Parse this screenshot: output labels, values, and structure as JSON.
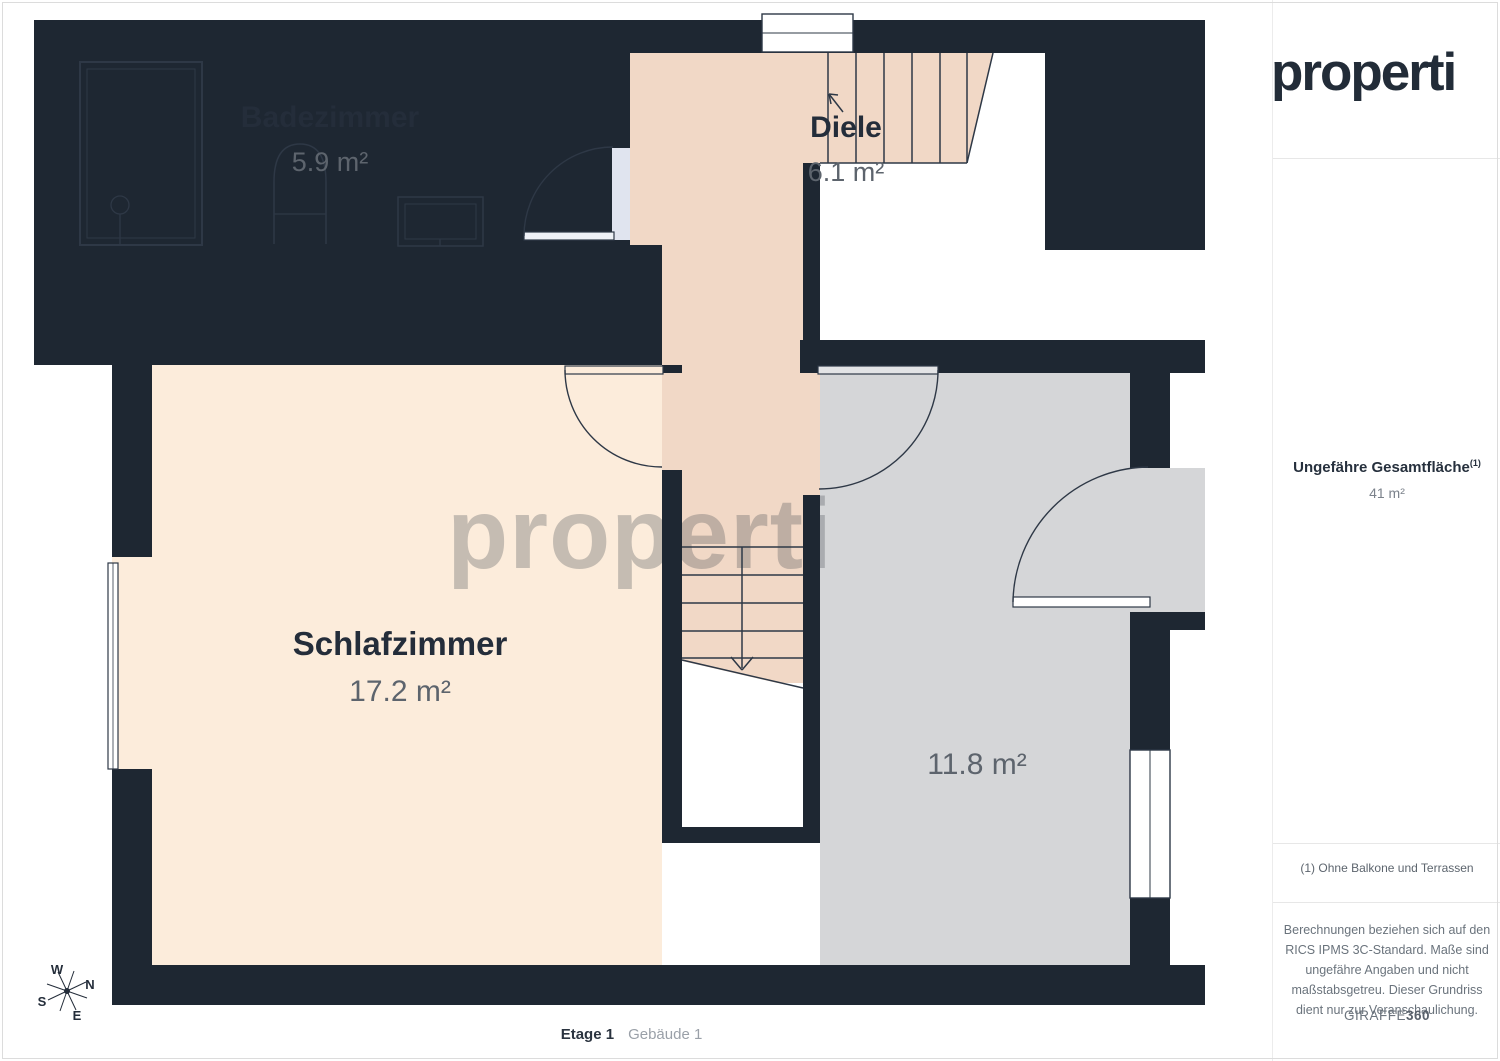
{
  "brand": {
    "logo": "properti",
    "watermark": "properti"
  },
  "floorplan": {
    "rooms": {
      "badezimmer": {
        "name": "Badezimmer",
        "area": "5.9 m²"
      },
      "diele": {
        "name": "Diele",
        "area": "6.1 m²"
      },
      "schlafzimmer": {
        "name": "Schlafzimmer",
        "area": "17.2 m²"
      },
      "room4": {
        "area": "11.8 m²"
      }
    },
    "compass": {
      "n": "N",
      "e": "E",
      "s": "S",
      "w": "W"
    }
  },
  "sidebar": {
    "total_area_label": "Ungefähre Gesamtfläche",
    "total_area_footnote_marker": "(1)",
    "total_area_value": "41 m²",
    "footnote": "(1) Ohne Balkone und Terrassen",
    "disclaimer": "Berechnungen beziehen sich auf den RICS IPMS 3C-Standard. Maße sind ungefähre Angaben und nicht maßstabsgetreu. Dieser Grundriss dient nur zur Veranschaulichung.",
    "vendor_prefix": "GIRAFFE",
    "vendor_suffix": "360"
  },
  "footer": {
    "floor_label": "Etage 1",
    "building_label": "Gebäude 1"
  },
  "colors": {
    "wall": "#1e2732",
    "bath_floor": "#e0e4ef",
    "hall_floor": "#f1d8c6",
    "bedroom_floor": "#fcecdb",
    "gray_room_floor": "#d5d6d8",
    "heading_text": "#242d3a",
    "muted_text": "#5d646d"
  }
}
